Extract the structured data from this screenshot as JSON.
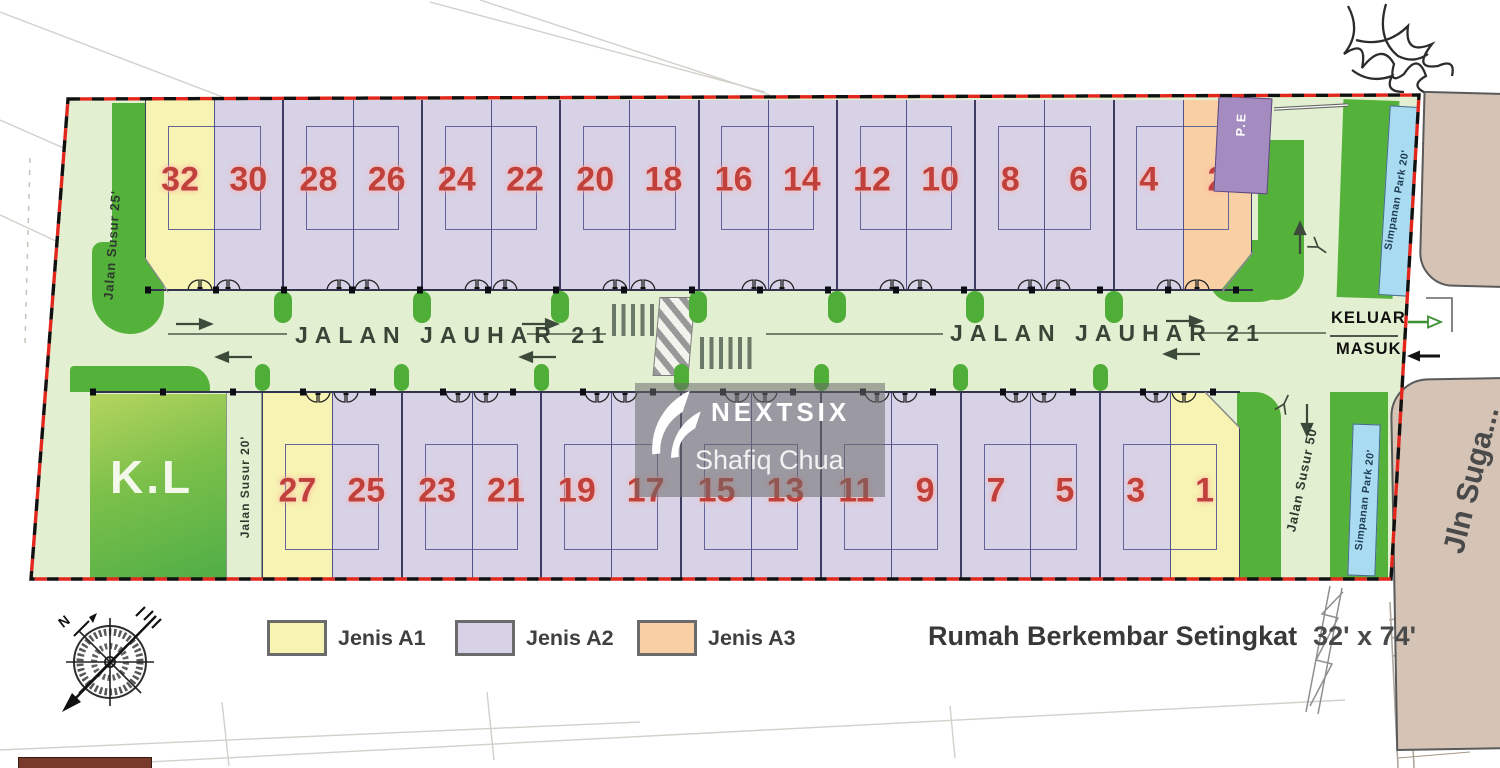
{
  "roads": {
    "main_left": "JALAN JAUHAR 21",
    "main_right": "JALAN JAUHAR 21",
    "susur25": "Jalan Susur 25'",
    "susur20": "Jalan Susur 20'",
    "susur50": "Jalan Susur 50'",
    "external": "Jln Suga...",
    "exit": "KELUAR",
    "entry": "MASUK"
  },
  "labels": {
    "kl": "K.L",
    "pe": "P.E",
    "park_top": "Simpanan Park 20'",
    "park_bottom": "Simpanan Park 20'",
    "north": "N"
  },
  "lots": {
    "top_row": [
      {
        "no": "32",
        "type": "A1"
      },
      {
        "no": "30",
        "type": "A2"
      },
      {
        "no": "28",
        "type": "A2"
      },
      {
        "no": "26",
        "type": "A2"
      },
      {
        "no": "24",
        "type": "A2"
      },
      {
        "no": "22",
        "type": "A2"
      },
      {
        "no": "20",
        "type": "A2"
      },
      {
        "no": "18",
        "type": "A2"
      },
      {
        "no": "16",
        "type": "A2"
      },
      {
        "no": "14",
        "type": "A2"
      },
      {
        "no": "12",
        "type": "A2"
      },
      {
        "no": "10",
        "type": "A2"
      },
      {
        "no": "8",
        "type": "A2"
      },
      {
        "no": "6",
        "type": "A2"
      },
      {
        "no": "4",
        "type": "A2"
      },
      {
        "no": "2",
        "type": "A3"
      }
    ],
    "bottom_row": [
      {
        "no": "27",
        "type": "A1"
      },
      {
        "no": "25",
        "type": "A2"
      },
      {
        "no": "23",
        "type": "A2"
      },
      {
        "no": "21",
        "type": "A2"
      },
      {
        "no": "19",
        "type": "A2"
      },
      {
        "no": "17",
        "type": "A2"
      },
      {
        "no": "15",
        "type": "A2"
      },
      {
        "no": "13",
        "type": "A2"
      },
      {
        "no": "11",
        "type": "A2"
      },
      {
        "no": "9",
        "type": "A2"
      },
      {
        "no": "7",
        "type": "A2"
      },
      {
        "no": "5",
        "type": "A2"
      },
      {
        "no": "3",
        "type": "A2"
      },
      {
        "no": "1",
        "type": "A1"
      }
    ]
  },
  "type_colors": {
    "A1": "#f7f3b2",
    "A2": "#d8d2e7",
    "A3": "#f9cfa4"
  },
  "legend": {
    "items": [
      {
        "label": "Jenis A1",
        "color": "#f7f3b2"
      },
      {
        "label": "Jenis A2",
        "color": "#d8d2e7"
      },
      {
        "label": "Jenis A3",
        "color": "#f9cfa4"
      }
    ],
    "title": "Rumah Berkembar Setingkat",
    "size": "32' x 74'"
  },
  "watermark": {
    "brand": "NEXTSIX",
    "agent": "Shafiq Chua"
  },
  "icons": {
    "compass": "compass-rose",
    "tree": "tree-marker",
    "gate": "gate-swing-arcs",
    "boundary": "red-black-dashed-site-boundary"
  }
}
